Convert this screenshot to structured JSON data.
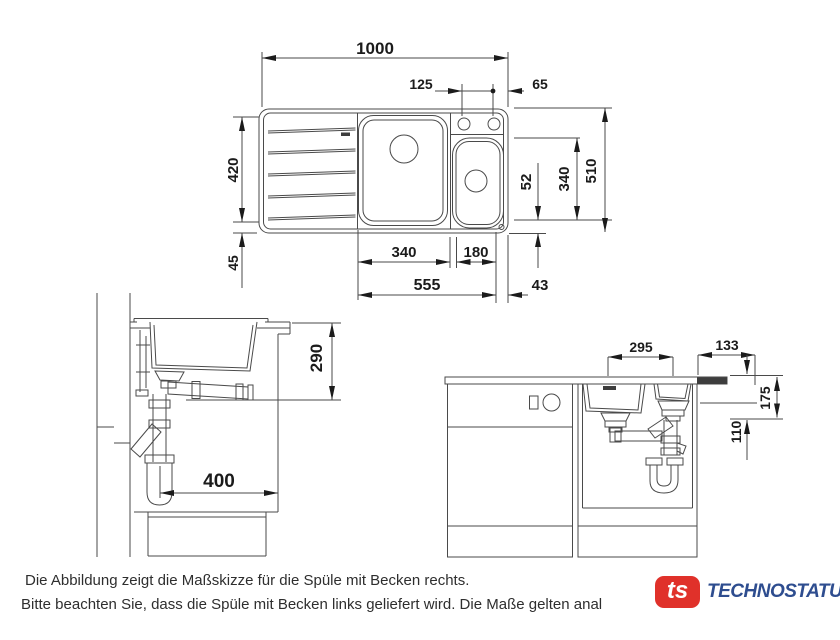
{
  "drawing": {
    "top_view": {
      "total_width": "1000",
      "tap_hole_spacing": "125",
      "tap_hole_to_edge": "65",
      "drainer_depth": "420",
      "front_edge": "45",
      "main_bowl_width": "340",
      "small_bowl_width": "180",
      "bowls_total_width": "555",
      "bowl_to_edge": "43",
      "rear_gap": "52",
      "bowl_depth": "340",
      "total_depth": "510"
    },
    "side_view": {
      "height_below_worktop": "290",
      "cabinet_inner_depth": "400"
    },
    "front_view": {
      "drain_spacing": "295",
      "right_offset": "133",
      "outlet_upper": "175",
      "outlet_lower": "110"
    }
  },
  "footer": {
    "line1": "Die Abbildung zeigt die Maßskizze für die Spüle mit Becken rechts.",
    "line2": "Bitte beachten Sie, dass die Spüle mit Becken links geliefert wird. Die Maße gelten anal"
  },
  "logo": {
    "mark": "ts",
    "text": "TECHNOSTATUS",
    "red": "#e0312a",
    "blue": "#2e4d8f"
  },
  "colors": {
    "line": "#4a4a4a",
    "dimension_text": "#1b1b1b"
  }
}
